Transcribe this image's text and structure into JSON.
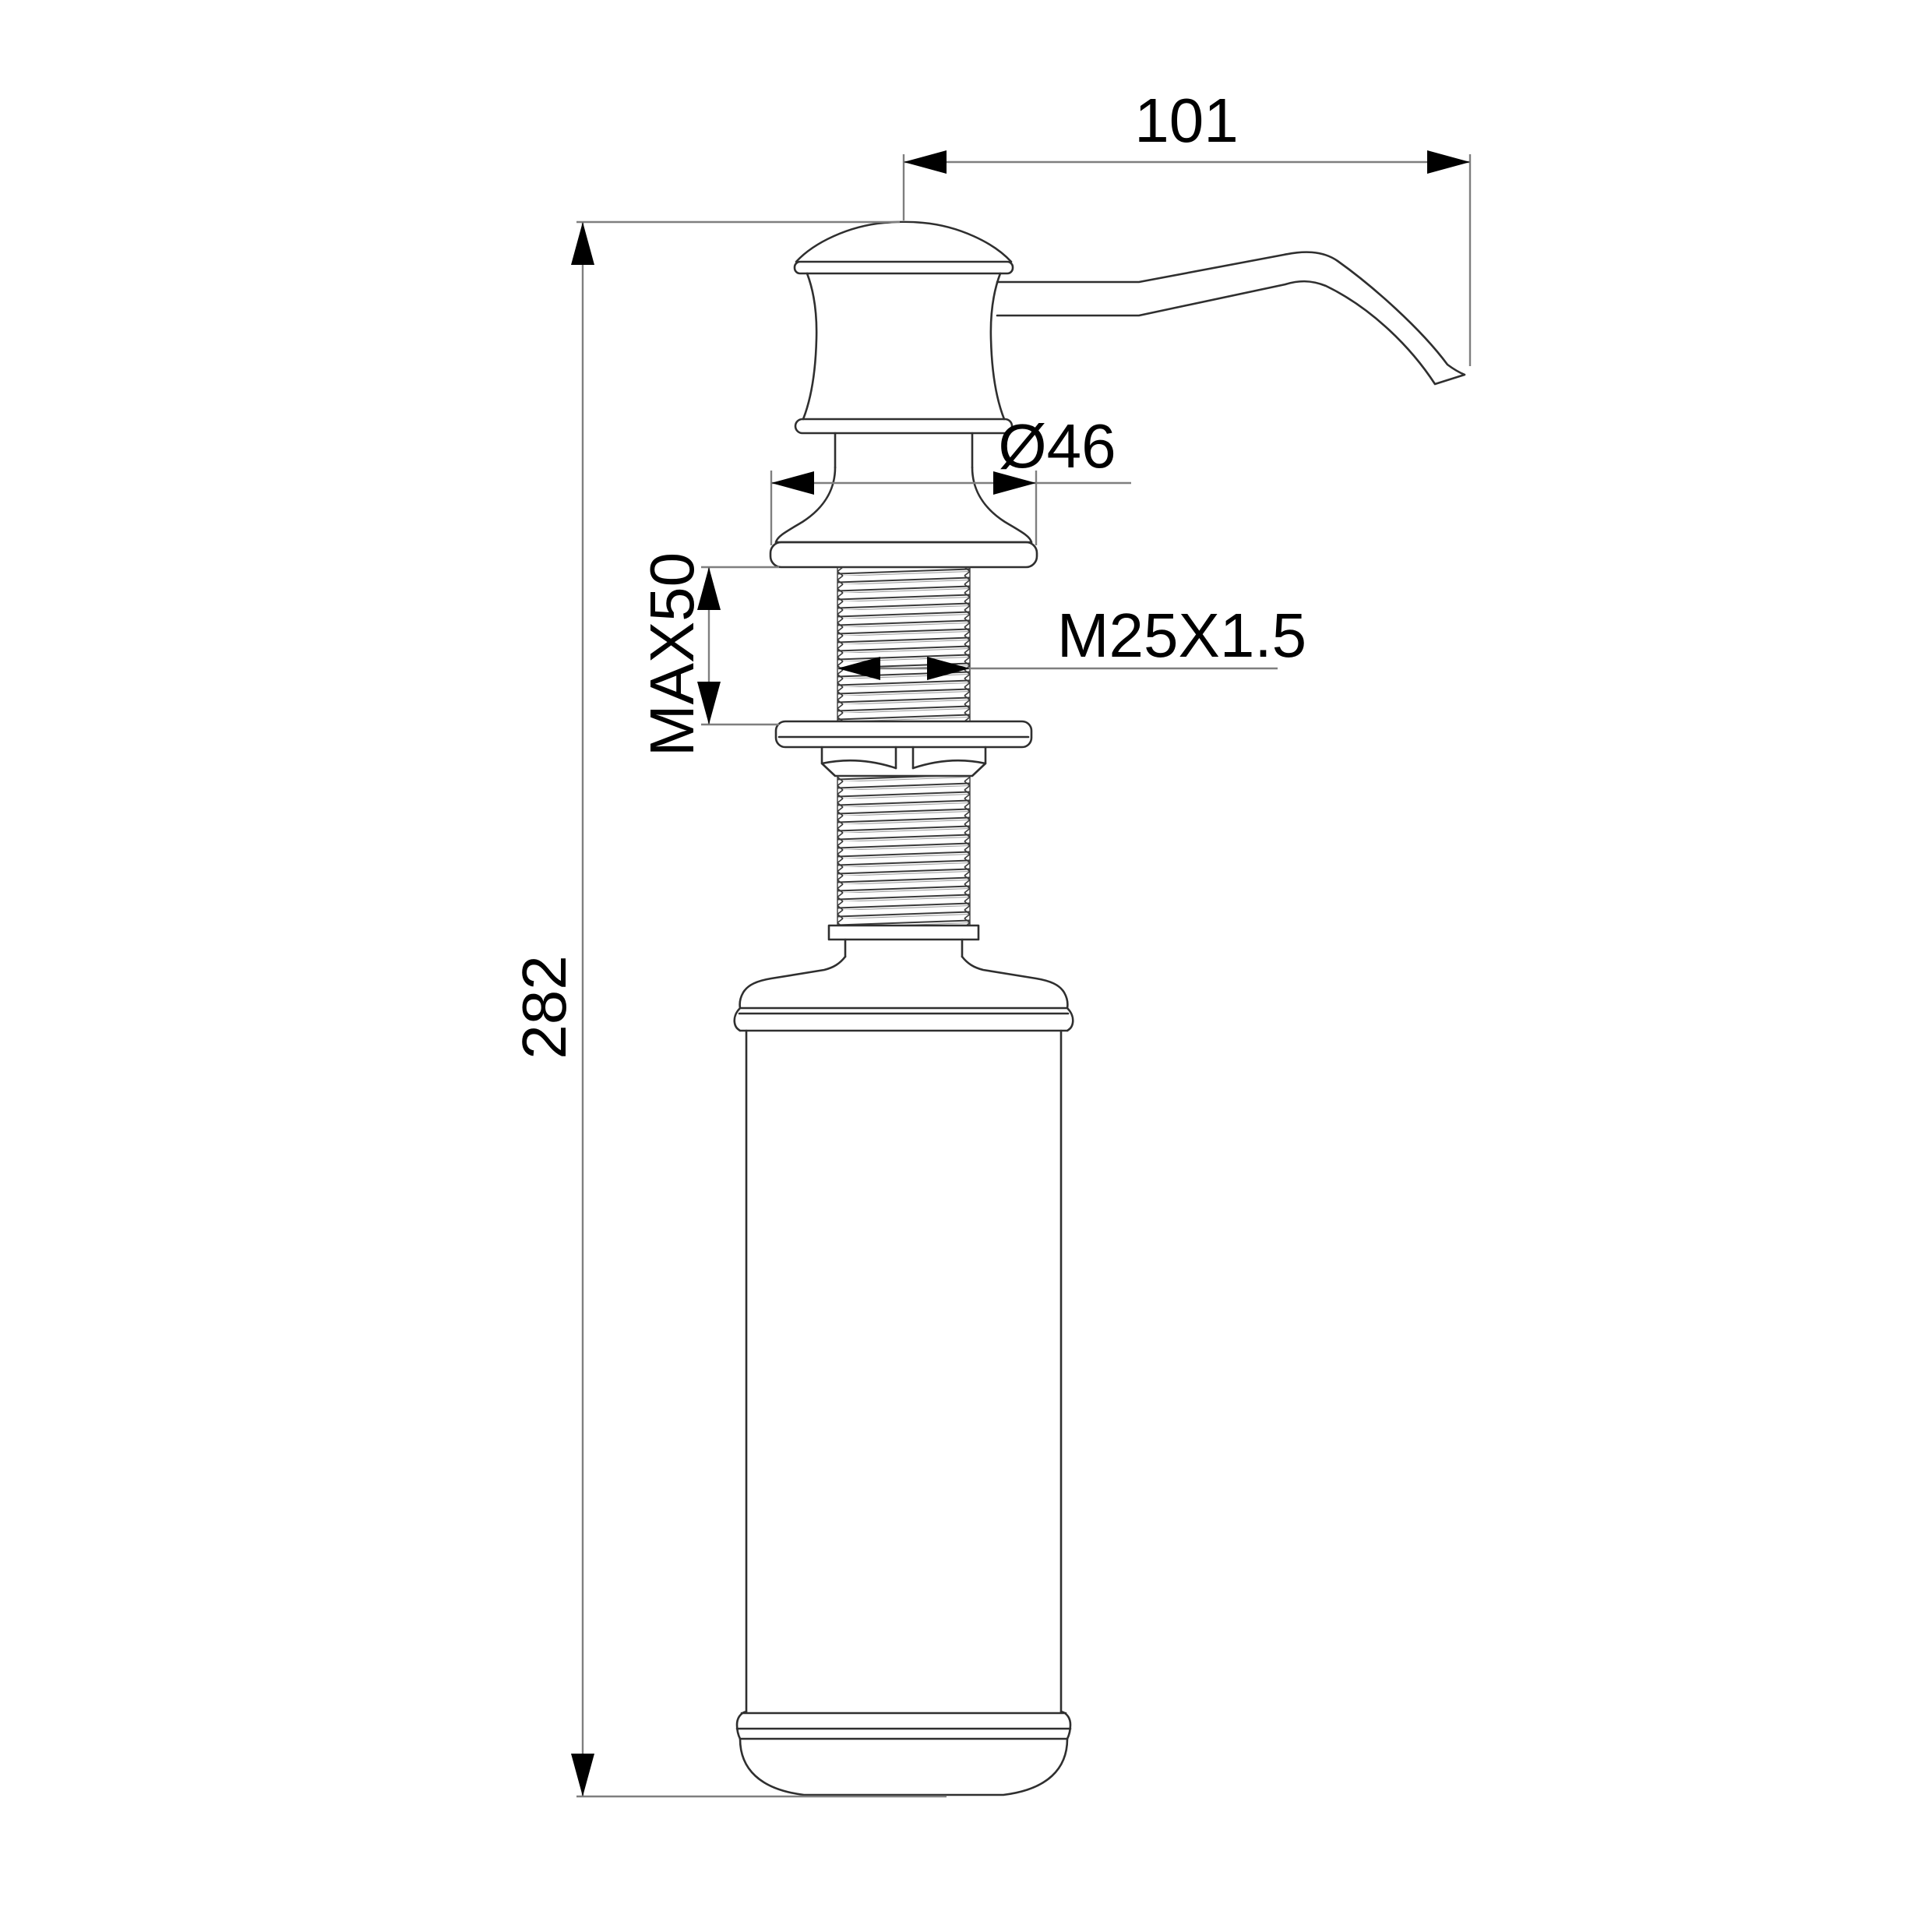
{
  "drawing": {
    "title": "soap-dispenser-technical-drawing",
    "dimensions": {
      "spout_reach": "101",
      "flange_diameter": "Ø46",
      "max_deck_thickness": "MAX50",
      "thread_spec": "M25X1.5",
      "total_height": "282"
    },
    "colors": {
      "outline": "#2f2f2f",
      "dimension_line": "#7f7f7f",
      "arrow": "#000000",
      "background": "#ffffff"
    }
  }
}
